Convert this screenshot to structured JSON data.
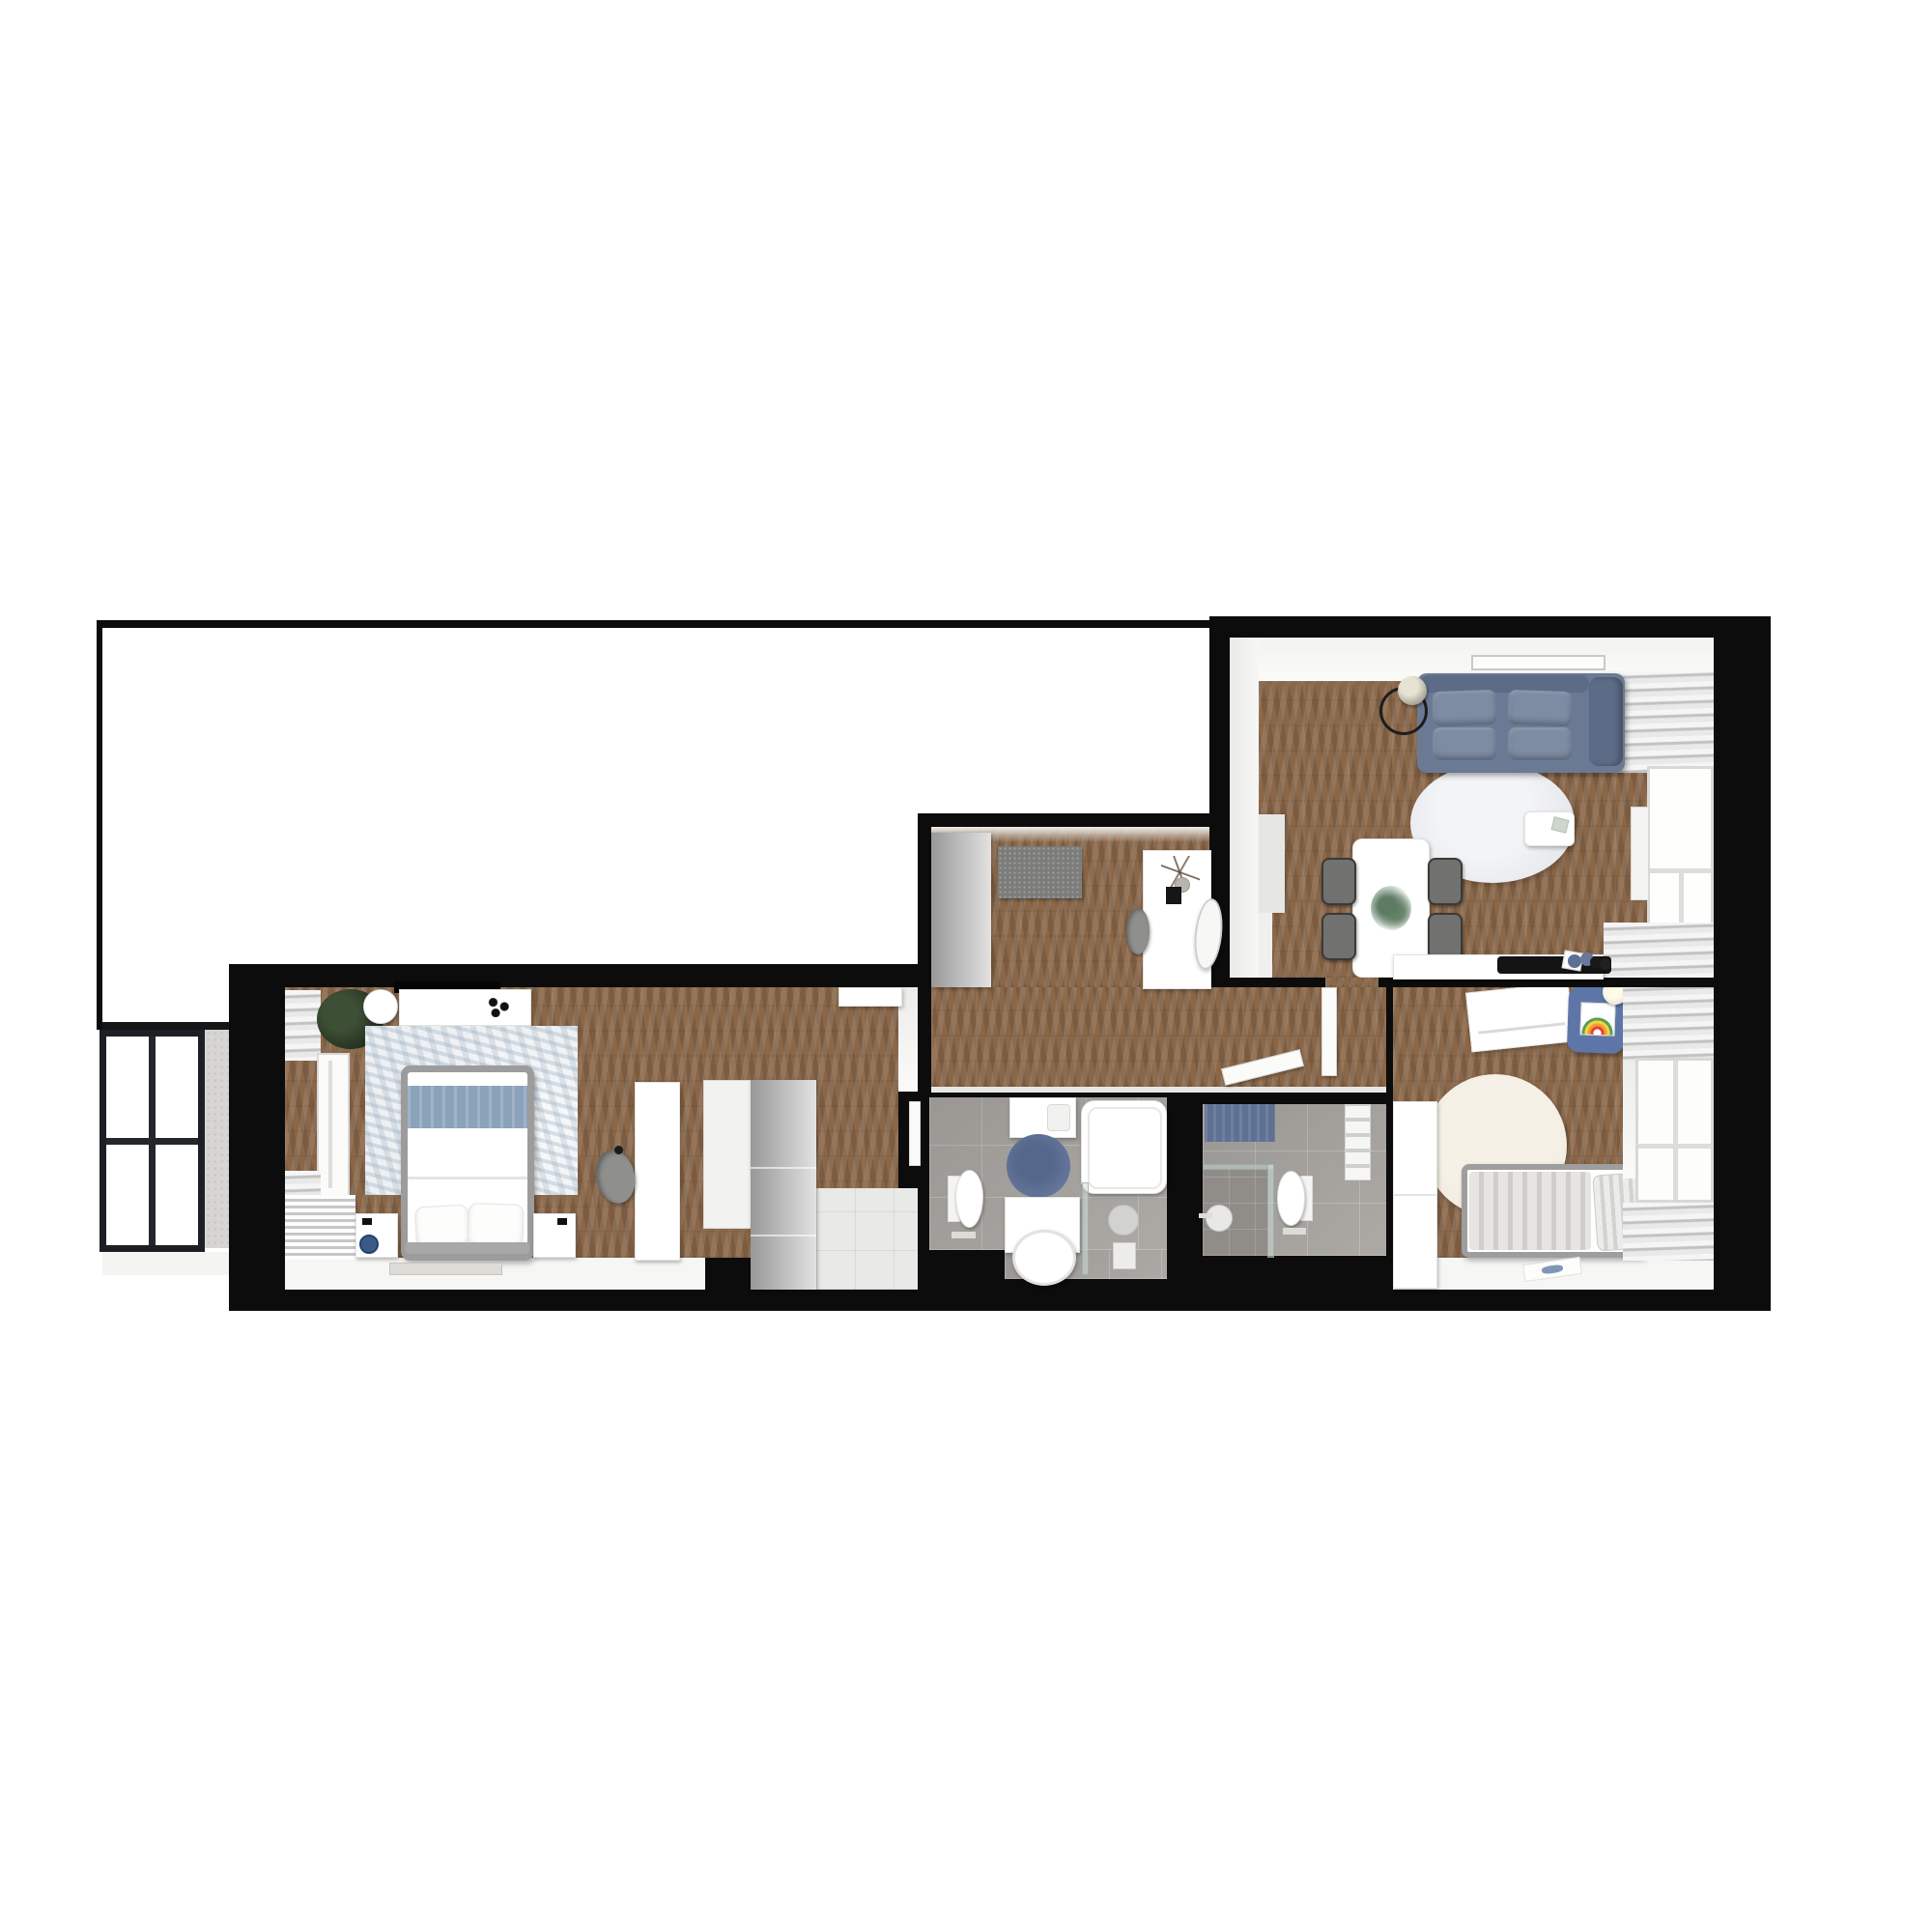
{
  "image_type": "3d-rendered apartment floor plan, top-down view, no visible text",
  "palette": {
    "wallBlack": "#0c0c0c",
    "wood": "#8a6748",
    "tileFloor": "#a7a4a0",
    "entryTile": "#e9e9e7",
    "concrete": "#d6d5d1",
    "sofa": "#6b7a94",
    "sofaLight": "#7d8ba3",
    "sofaDark": "#5d6c86",
    "bedThrow": "#8ba2bb",
    "kidsChair": "#5e76a7",
    "bathRug": "#63759a",
    "towel": "#5f7193",
    "vase": "#3b5a86",
    "grayRug": "#7c7c7a",
    "creamRug": "#f0ebdf",
    "rugLiving": "#e7e9ed",
    "rugBedroom": "#eef0f2",
    "frameGray": "#9c9c9c"
  },
  "rooms": [
    {
      "id": "empty-room",
      "description": "large unfurnished white room, top left, with corridor down to balcony"
    },
    {
      "id": "balcony",
      "description": "bottom left, black framed 2x2 window and concrete pillar"
    },
    {
      "id": "bedroom",
      "description": "double bed with blue throw, rug, dresser, TV, wardrobe, desk with chair, radiator and curtained window"
    },
    {
      "id": "dressing-room",
      "description": "middle top room with gray cabinet, gray rug, white console, oval mirror, stool"
    },
    {
      "id": "hallway",
      "description": "wood corridor with two open door leaves"
    },
    {
      "id": "bathroom-1",
      "description": "gray tiled, washer, bathtub, blue round rug, toilet, vanity with round sink, glass shower"
    },
    {
      "id": "bathroom-2",
      "description": "gray tiled, blue towel, walk-in glass shower, toilet, towel radiator"
    },
    {
      "id": "living-room",
      "description": "blue sofa, floor lamp, round marble rug, coffee table, white dining table with 4 gray chairs, sideboard with tray and bottles, curtains and window"
    },
    {
      "id": "kids-room",
      "description": "angled desk, blue chair with rainbow drawing, cream round rug, single bed with striped duvet, wardrobe, window with curtains"
    }
  ]
}
